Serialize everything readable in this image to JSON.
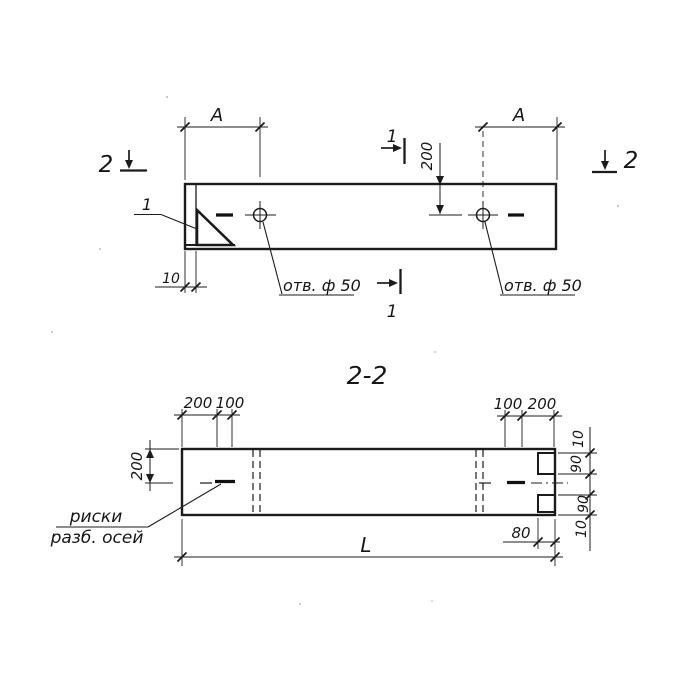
{
  "meta": {
    "kind": "engineering-drawing",
    "language": "ru",
    "description": "Precast element: plan view with two holes and section 2-2"
  },
  "colors": {
    "ink": "#1b1b1b",
    "paper": "#ffffff"
  },
  "top_view": {
    "dim_a": "A",
    "section_mark_2": "2",
    "section_mark_1": "1",
    "detail_callout": "1",
    "dim_top_to_hole": "200",
    "dim_edge_offset": "10",
    "hole_note": "отв. ф 50"
  },
  "section_view": {
    "title": "2-2",
    "dim_left_outer": "200",
    "dim_left_inner": "100",
    "dim_right_inner": "100",
    "dim_right_outer": "200",
    "dim_height_to_axis": "200",
    "edge_chain": [
      "10",
      "90",
      "90",
      "10"
    ],
    "dim_notch_depth": "80",
    "dim_length": "L",
    "axis_note_line1": "риски",
    "axis_note_line2": "разб. осей"
  }
}
